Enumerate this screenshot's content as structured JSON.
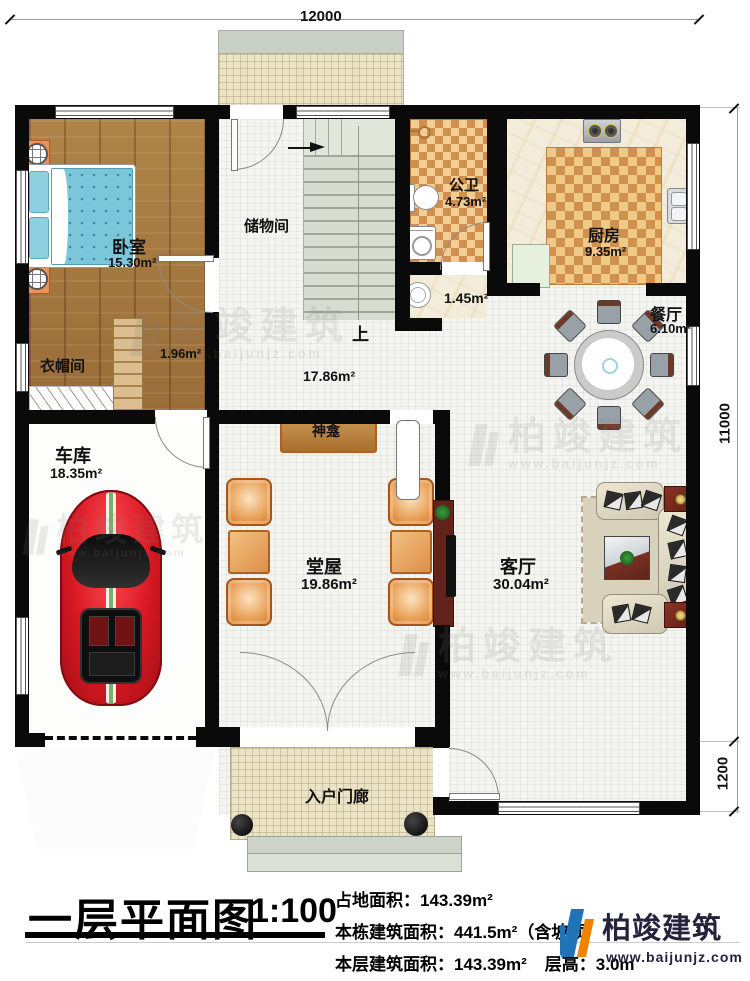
{
  "dims": {
    "top": "12000",
    "right_upper": "11000",
    "right_lower": "1200"
  },
  "rooms": {
    "bedroom": {
      "name": "卧室",
      "area": "15.30m²"
    },
    "cloakroom": {
      "name": "衣帽间",
      "area": "1.96m²"
    },
    "storage": {
      "name": "储物间"
    },
    "bath": {
      "name": "公卫",
      "area": "4.73m²"
    },
    "wash": {
      "area": "1.45m²"
    },
    "kitchen": {
      "name": "厨房",
      "area": "9.35m²"
    },
    "dining": {
      "name": "餐厅",
      "area": "6.10m²"
    },
    "hallway": {
      "area": "17.86m²"
    },
    "stairs": {
      "up_label": "上"
    },
    "shrine": {
      "name": "神龛"
    },
    "tangwu": {
      "name": "堂屋",
      "area": "19.86m²"
    },
    "living": {
      "name": "客厅",
      "area": "30.04m²"
    },
    "garage": {
      "name": "车库",
      "area": "18.35m²"
    },
    "porch": {
      "name": "入户门廊"
    }
  },
  "titleblock": {
    "title": "一层平面图",
    "scale": "1:100",
    "land_area": "占地面积：143.39m²",
    "bldg_area_prefix": "本栋建筑面积：441.5m²（含坡顶",
    "bldg_area_suffix": "²）",
    "floor_area": "本层建筑面积：143.39m²",
    "floor_height": "层高：3.0m"
  },
  "brand": {
    "name": "柏竣建筑",
    "url": "www.baijunjz.com"
  },
  "watermark": {
    "name": "柏竣建筑",
    "url": "www.baijunjz.com"
  },
  "colors": {
    "wall": "#0a0a0a",
    "checker_dark": "#d08f50",
    "checker_light": "#f2ce92",
    "accent_blue": "#1f74b8",
    "accent_orange": "#ef8200"
  }
}
